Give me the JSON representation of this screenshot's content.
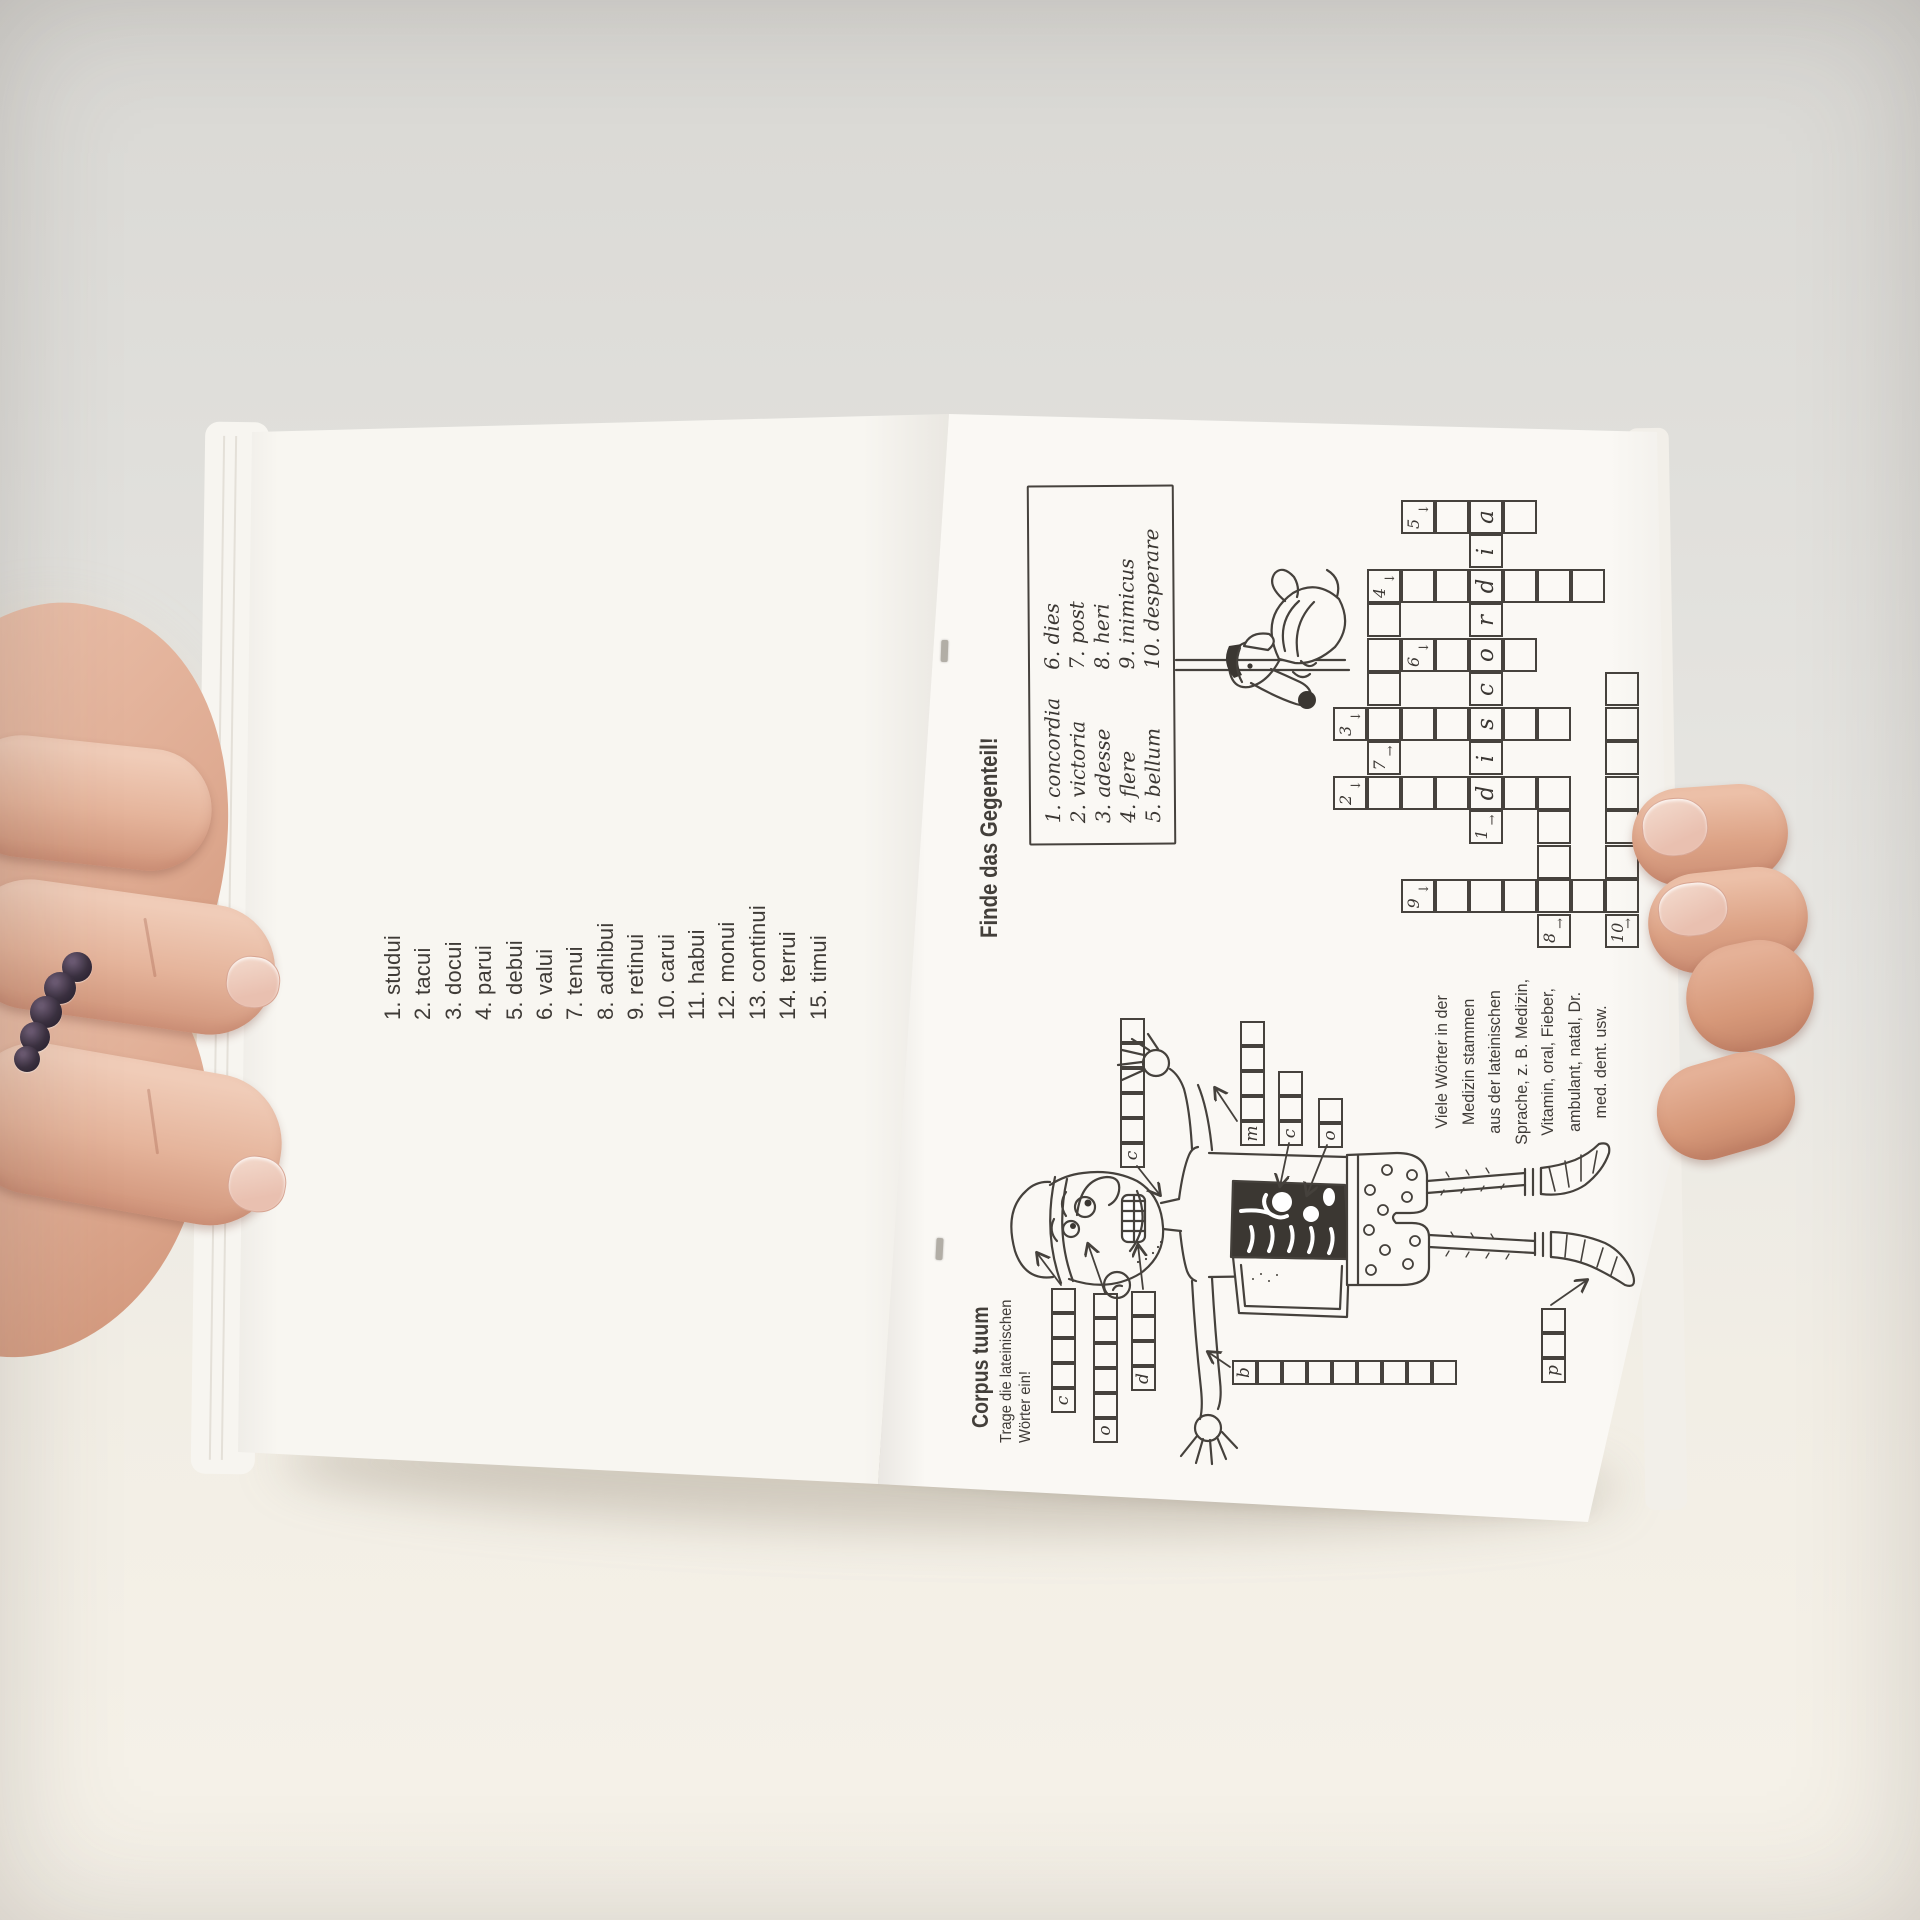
{
  "left_page": {
    "verbs": [
      "1. studui",
      "2. tacui",
      "3. docui",
      "4. parui",
      "5. debui",
      "6. valui",
      "7. tenui",
      "8. adhibui",
      "9. retinui",
      "10. carui",
      "11. habui",
      "12. monui",
      "13. continui",
      "14. terrui",
      "15. timui"
    ]
  },
  "right_page": {
    "gegenteil": {
      "heading": "Finde das Gegenteil!",
      "word_box_col1": [
        "1. concordia",
        "2. victoria",
        "3. adesse",
        "4. flere",
        "5. bellum"
      ],
      "word_box_col2": [
        "6. dies",
        "7. post",
        "8. heri",
        "9. inimicus",
        "10. desperare"
      ],
      "crossword": {
        "filled_answer": "discordia",
        "cells": [
          {
            "r": 0,
            "c": 4,
            "n": "2",
            "d": "down"
          },
          {
            "r": 0,
            "c": 6,
            "n": "3",
            "d": "down"
          },
          {
            "r": 1,
            "c": 4
          },
          {
            "r": 1,
            "c": 5,
            "n": "7",
            "d": "right"
          },
          {
            "r": 1,
            "c": 6
          },
          {
            "r": 1,
            "c": 7
          },
          {
            "r": 1,
            "c": 8
          },
          {
            "r": 1,
            "c": 9
          },
          {
            "r": 1,
            "c": 10,
            "n": "4",
            "d": "down"
          },
          {
            "r": 2,
            "c": 1,
            "n": "9",
            "d": "down"
          },
          {
            "r": 2,
            "c": 4
          },
          {
            "r": 2,
            "c": 6
          },
          {
            "r": 2,
            "c": 8,
            "n": "6",
            "d": "down"
          },
          {
            "r": 2,
            "c": 10
          },
          {
            "r": 2,
            "c": 12,
            "n": "5",
            "d": "down"
          },
          {
            "r": 3,
            "c": 1
          },
          {
            "r": 3,
            "c": 4
          },
          {
            "r": 3,
            "c": 6
          },
          {
            "r": 3,
            "c": 8
          },
          {
            "r": 3,
            "c": 10
          },
          {
            "r": 3,
            "c": 12
          },
          {
            "r": 4,
            "c": 1
          },
          {
            "r": 4,
            "c": 3,
            "n": "1",
            "d": "right"
          },
          {
            "r": 4,
            "c": 4,
            "l": "d"
          },
          {
            "r": 4,
            "c": 5,
            "l": "i"
          },
          {
            "r": 4,
            "c": 6,
            "l": "s"
          },
          {
            "r": 4,
            "c": 7,
            "l": "c"
          },
          {
            "r": 4,
            "c": 8,
            "l": "o"
          },
          {
            "r": 4,
            "c": 9,
            "l": "r"
          },
          {
            "r": 4,
            "c": 10,
            "l": "d"
          },
          {
            "r": 4,
            "c": 11,
            "l": "i"
          },
          {
            "r": 4,
            "c": 12,
            "l": "a"
          },
          {
            "r": 5,
            "c": 1
          },
          {
            "r": 5,
            "c": 4
          },
          {
            "r": 5,
            "c": 6
          },
          {
            "r": 5,
            "c": 8
          },
          {
            "r": 5,
            "c": 10
          },
          {
            "r": 5,
            "c": 12
          },
          {
            "r": 6,
            "c": 0,
            "n": "8",
            "d": "right"
          },
          {
            "r": 6,
            "c": 1
          },
          {
            "r": 6,
            "c": 2
          },
          {
            "r": 6,
            "c": 3
          },
          {
            "r": 6,
            "c": 4
          },
          {
            "r": 6,
            "c": 6
          },
          {
            "r": 6,
            "c": 10
          },
          {
            "r": 7,
            "c": 1
          },
          {
            "r": 7,
            "c": 10
          },
          {
            "r": 8,
            "c": 0,
            "n": "10",
            "d": "right"
          },
          {
            "r": 8,
            "c": 1
          },
          {
            "r": 8,
            "c": 2
          },
          {
            "r": 8,
            "c": 3
          },
          {
            "r": 8,
            "c": 4
          },
          {
            "r": 8,
            "c": 5
          },
          {
            "r": 8,
            "c": 6
          },
          {
            "r": 8,
            "c": 7
          }
        ]
      }
    },
    "corpus": {
      "heading": "Corpus tuum",
      "subheading": [
        "Trage die lateinischen",
        "Wörter ein!"
      ],
      "strips": [
        {
          "name": "caput",
          "letter": "c",
          "boxes": 5,
          "x": 134,
          "y": 102,
          "dir": "h"
        },
        {
          "name": "oculus",
          "letter": "o",
          "boxes": 6,
          "x": 104,
          "y": 144,
          "dir": "h"
        },
        {
          "name": "dens",
          "letter": "d",
          "boxes": 4,
          "x": 156,
          "y": 182,
          "dir": "h"
        },
        {
          "name": "collum",
          "letter": "c",
          "boxes": 6,
          "x": 379,
          "y": 171,
          "dir": "h"
        },
        {
          "name": "manus",
          "letter": "m",
          "boxes": 5,
          "x": 401,
          "y": 291,
          "dir": "h"
        },
        {
          "name": "cor",
          "letter": "c",
          "boxes": 3,
          "x": 401,
          "y": 329,
          "dir": "h"
        },
        {
          "name": "os",
          "letter": "o",
          "boxes": 2,
          "x": 399,
          "y": 369,
          "dir": "h"
        },
        {
          "name": "bracchium",
          "letter": "b",
          "boxes": 9,
          "x": 162,
          "y": 283,
          "dir": "v"
        },
        {
          "name": "pes",
          "letter": "p",
          "boxes": 3,
          "x": 164,
          "y": 592,
          "dir": "h"
        }
      ],
      "note": [
        "Viele Wörter in der",
        "Medizin stammen",
        "aus der lateinischen",
        "Sprache, z. B. Medizin,",
        "Vitamin, oral, Fieber,",
        "ambulant, natal, Dr.",
        "med. dent. usw."
      ]
    }
  },
  "colors": {
    "paper_left": "#f8f6f1",
    "paper_right": "#faf8f4",
    "ink": "#45413c",
    "print_text": "#3f3b37",
    "background_top": "#d9d8d4",
    "table": "#f6f2e9",
    "skin_light": "#f0ccb8",
    "skin_mid": "#e5b49b",
    "skin_shadow": "#d49a80",
    "nail": "#e9c0b0",
    "ring_bead": "#3a3040"
  }
}
